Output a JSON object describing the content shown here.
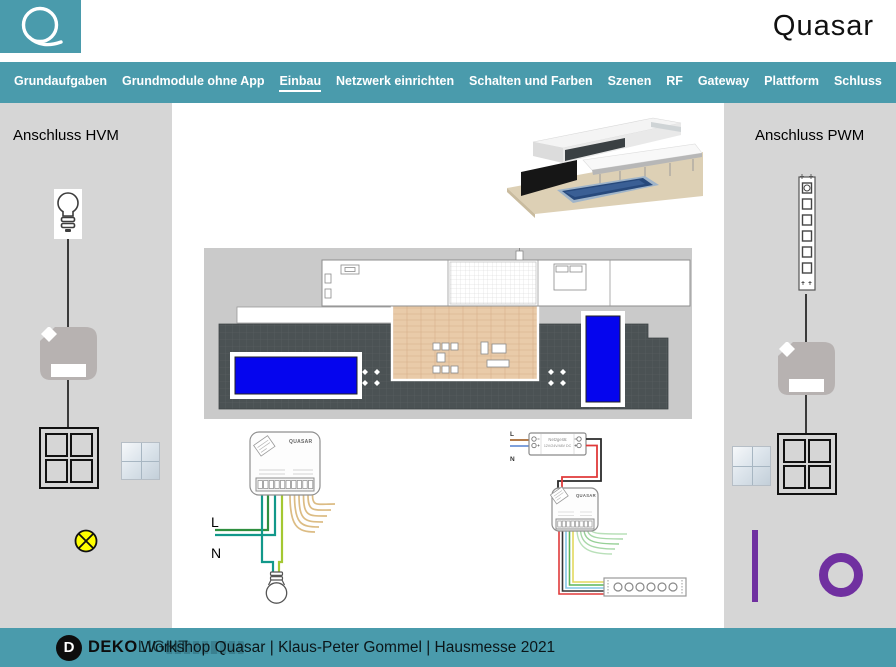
{
  "header": {
    "brand": "Quasar"
  },
  "nav": {
    "items": [
      {
        "label": "Grundaufgaben",
        "active": false
      },
      {
        "label": "Grundmodule ohne App",
        "active": false
      },
      {
        "label": "Einbau",
        "active": true
      },
      {
        "label": "Netzwerk einrichten",
        "active": false
      },
      {
        "label": "Schalten und Farben",
        "active": false
      },
      {
        "label": "Szenen",
        "active": false
      },
      {
        "label": "RF",
        "active": false
      },
      {
        "label": "Gateway",
        "active": false
      },
      {
        "label": "Plattform",
        "active": false
      },
      {
        "label": "Schluss",
        "active": false
      }
    ]
  },
  "left_panel": {
    "title": "Anschluss HVM"
  },
  "right_panel": {
    "title": "Anschluss PWM"
  },
  "wiring_hvm": {
    "module_label": "QUASAR",
    "line_label": "L",
    "neutral_label": "N"
  },
  "wiring_pwm": {
    "line_label": "L",
    "neutral_label": "N",
    "psu_line1": "Netzgerät",
    "psu_line2": "12V/24V/48V DC",
    "module_label": "QUASAR"
  },
  "footer": {
    "logo_initial": "D",
    "logo_bold": "DEKO",
    "logo_light": "LIGHT",
    "caption": "Workshop Quasar | Klaus-Peter Gommel | Hausmesse 2021"
  },
  "colors": {
    "teal": "#4A9BAC",
    "panel_gray": "#D6D6D6",
    "purple": "#7030A0",
    "pool_blue": "#0505EE",
    "lamp_yellow": "#FFFF00"
  }
}
